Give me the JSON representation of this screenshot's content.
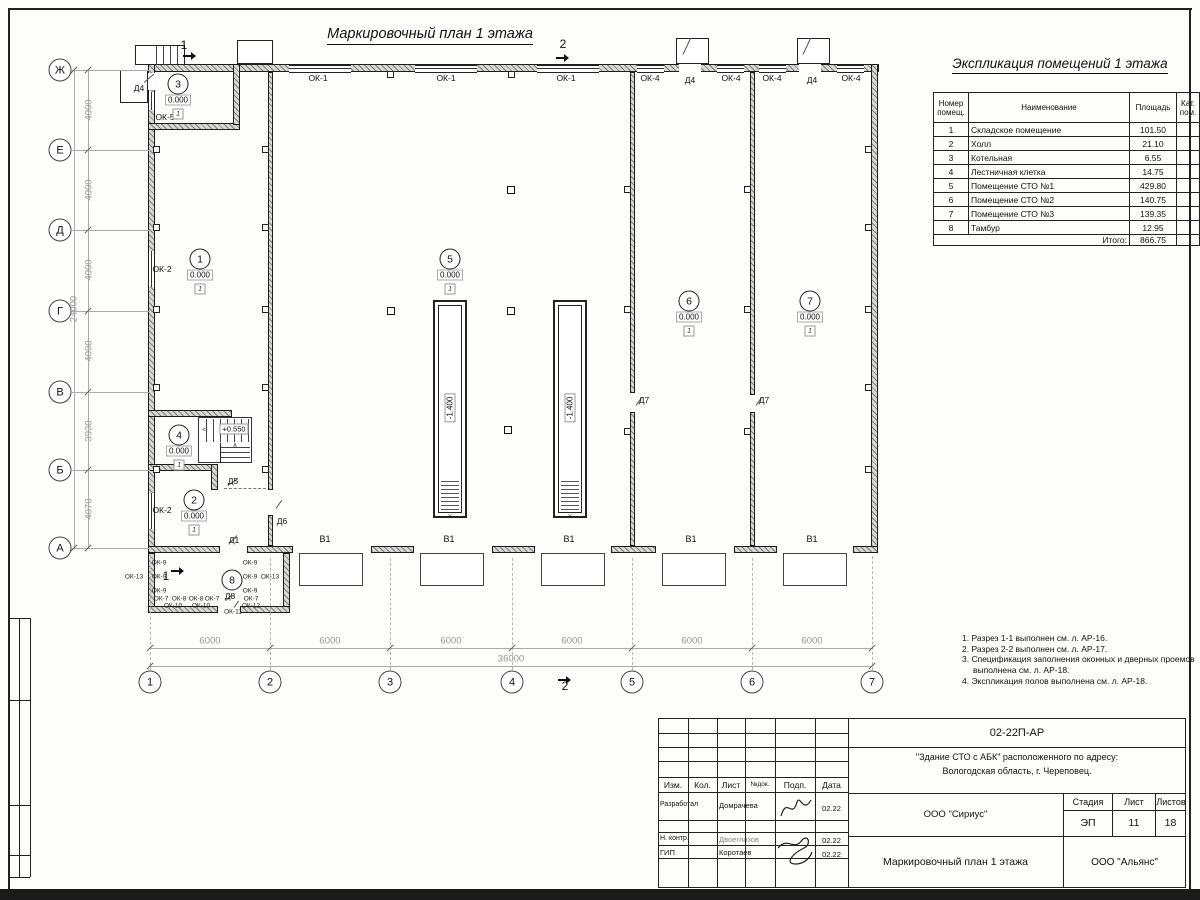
{
  "sheet": {
    "plan_title": "Маркировочный план 1 этажа",
    "expl_title": "Экспликация помещений 1 этажа"
  },
  "expl_table": {
    "headers": [
      "Номер помещ.",
      "Наименование",
      "Площадь",
      "Кат. пом."
    ],
    "rows": [
      [
        "1",
        "Складское помещение",
        "101.50",
        ""
      ],
      [
        "2",
        "Холл",
        "21.10",
        ""
      ],
      [
        "3",
        "Котельная",
        "6.55",
        ""
      ],
      [
        "4",
        "Лестничная клетка",
        "14.75",
        ""
      ],
      [
        "5",
        "Помещение СТО №1",
        "429.80",
        ""
      ],
      [
        "6",
        "Помещение СТО №2",
        "140.75",
        ""
      ],
      [
        "7",
        "Помещение СТО №3",
        "139.35",
        ""
      ],
      [
        "8",
        "Тамбур",
        "12.95",
        ""
      ]
    ],
    "total_label": "Итого:",
    "total_value": "866.75"
  },
  "notes": [
    "1. Разрез 1-1 выполнен см. л. АР-16.",
    "2. Разрез 2-2 выполнен см. л. АР-17.",
    "3. Спецификация заполнения оконных и дверных проемов выполнена см. л. АР-18.",
    "4. Экспликация полов выполнена см. л. АР-18."
  ],
  "plan": {
    "axis_rows": [
      {
        "t": "Ж",
        "x": 60,
        "y": 70
      },
      {
        "t": "Е",
        "x": 60,
        "y": 150
      },
      {
        "t": "Д",
        "x": 60,
        "y": 230
      },
      {
        "t": "Г",
        "x": 60,
        "y": 311
      },
      {
        "t": "В",
        "x": 60,
        "y": 392
      },
      {
        "t": "Б",
        "x": 60,
        "y": 470
      },
      {
        "t": "А",
        "x": 60,
        "y": 548
      }
    ],
    "axis_cols": [
      {
        "t": "1",
        "x": 150,
        "y": 682
      },
      {
        "t": "2",
        "x": 270,
        "y": 682
      },
      {
        "t": "3",
        "x": 390,
        "y": 682
      },
      {
        "t": "4",
        "x": 512,
        "y": 682
      },
      {
        "t": "5",
        "x": 632,
        "y": 682
      },
      {
        "t": "6",
        "x": 752,
        "y": 682
      },
      {
        "t": "7",
        "x": 872,
        "y": 682
      }
    ],
    "dims": [
      {
        "t": "4000",
        "x": 89,
        "y": 110,
        "r": 1
      },
      {
        "t": "4000",
        "x": 89,
        "y": 190,
        "r": 1
      },
      {
        "t": "4000",
        "x": 89,
        "y": 270,
        "r": 1
      },
      {
        "t": "4000",
        "x": 89,
        "y": 351,
        "r": 1
      },
      {
        "t": "3930",
        "x": 89,
        "y": 431,
        "r": 1
      },
      {
        "t": "4070",
        "x": 89,
        "y": 509,
        "r": 1
      },
      {
        "t": "24000",
        "x": 74,
        "y": 309,
        "r": 1
      },
      {
        "t": "6000",
        "x": 210,
        "y": 641
      },
      {
        "t": "6000",
        "x": 330,
        "y": 641
      },
      {
        "t": "6000",
        "x": 451,
        "y": 641
      },
      {
        "t": "6000",
        "x": 572,
        "y": 641
      },
      {
        "t": "6000",
        "x": 692,
        "y": 641
      },
      {
        "t": "6000",
        "x": 812,
        "y": 641
      },
      {
        "t": "36000",
        "x": 511,
        "y": 659
      }
    ],
    "rooms": [
      {
        "n": "1",
        "x": 200,
        "y": 259,
        "e": "0.000",
        "f": "1"
      },
      {
        "n": "2",
        "x": 194,
        "y": 500,
        "e": "0.000",
        "f": "1"
      },
      {
        "n": "3",
        "x": 178,
        "y": 84,
        "e": "0.000",
        "f": "1"
      },
      {
        "n": "4",
        "x": 179,
        "y": 435,
        "e": "0.000",
        "f": "1"
      },
      {
        "n": "5",
        "x": 450,
        "y": 259,
        "e": "0.000",
        "f": "1"
      },
      {
        "n": "6",
        "x": 689,
        "y": 301,
        "e": "0.000",
        "f": "1"
      },
      {
        "n": "7",
        "x": 810,
        "y": 301,
        "e": "0.000",
        "f": "1"
      },
      {
        "n": "8",
        "x": 232,
        "y": 580
      }
    ],
    "labels": [
      {
        "t": "ОК-1",
        "x": 318,
        "y": 78
      },
      {
        "t": "ОК-1",
        "x": 446,
        "y": 78
      },
      {
        "t": "ОК-1",
        "x": 566,
        "y": 78
      },
      {
        "t": "ОК-4",
        "x": 650,
        "y": 78
      },
      {
        "t": "Д4",
        "x": 690,
        "y": 80
      },
      {
        "t": "ОК-4",
        "x": 731,
        "y": 78
      },
      {
        "t": "ОК-4",
        "x": 772,
        "y": 78
      },
      {
        "t": "Д4",
        "x": 812,
        "y": 80
      },
      {
        "t": "ОК-4",
        "x": 851,
        "y": 78
      },
      {
        "t": "Д4",
        "x": 139,
        "y": 88
      },
      {
        "t": "ОК-5",
        "x": 165,
        "y": 117
      },
      {
        "t": "ОК-2",
        "x": 162,
        "y": 269
      },
      {
        "t": "ОК-2",
        "x": 162,
        "y": 510
      },
      {
        "t": "Д5",
        "x": 233,
        "y": 481
      },
      {
        "t": "Д6",
        "x": 282,
        "y": 521
      },
      {
        "t": "Д1",
        "x": 234,
        "y": 540
      },
      {
        "t": "Д7",
        "x": 644,
        "y": 400
      },
      {
        "t": "Д7",
        "x": 764,
        "y": 400
      },
      {
        "t": "Д8",
        "x": 230,
        "y": 596
      },
      {
        "t": "В1",
        "x": 325,
        "y": 539,
        "c": "b1"
      },
      {
        "t": "В1",
        "x": 449,
        "y": 539,
        "c": "b1"
      },
      {
        "t": "В1",
        "x": 569,
        "y": 539,
        "c": "b1"
      },
      {
        "t": "В1",
        "x": 691,
        "y": 539,
        "c": "b1"
      },
      {
        "t": "В1",
        "x": 812,
        "y": 539,
        "c": "b1"
      },
      {
        "t": "ОК-13",
        "x": 134,
        "y": 577,
        "c": "t6"
      },
      {
        "t": "ОК-13",
        "x": 270,
        "y": 577,
        "c": "t6"
      },
      {
        "t": "ОК-9",
        "x": 159,
        "y": 563,
        "c": "t6"
      },
      {
        "t": "ОК-9",
        "x": 159,
        "y": 577,
        "c": "t6"
      },
      {
        "t": "ОК-9",
        "x": 159,
        "y": 591,
        "c": "t6"
      },
      {
        "t": "ОК-9",
        "x": 250,
        "y": 563,
        "c": "t6"
      },
      {
        "t": "ОК-9",
        "x": 250,
        "y": 577,
        "c": "t6"
      },
      {
        "t": "ОК-9",
        "x": 250,
        "y": 591,
        "c": "t6"
      },
      {
        "t": "ОК-7",
        "x": 161,
        "y": 599,
        "c": "t6"
      },
      {
        "t": "ОК-8",
        "x": 179,
        "y": 599,
        "c": "t6"
      },
      {
        "t": "ОК-8",
        "x": 196,
        "y": 599,
        "c": "t6"
      },
      {
        "t": "ОК-7",
        "x": 212,
        "y": 599,
        "c": "t6"
      },
      {
        "t": "ОК-7",
        "x": 251,
        "y": 599,
        "c": "t6"
      },
      {
        "t": "ОК-10",
        "x": 173,
        "y": 606,
        "c": "t6"
      },
      {
        "t": "ОК-10",
        "x": 201,
        "y": 606,
        "c": "t6"
      },
      {
        "t": "ОК-11",
        "x": 233,
        "y": 612,
        "c": "t6"
      },
      {
        "t": "ОК-12",
        "x": 251,
        "y": 606,
        "c": "t6"
      },
      {
        "t": "1",
        "x": 184,
        "y": 45,
        "c": "sec"
      },
      {
        "t": "2",
        "x": 563,
        "y": 44,
        "c": "sec"
      },
      {
        "t": "2",
        "x": 565,
        "y": 686,
        "c": "sec"
      },
      {
        "t": "1",
        "x": 166,
        "y": 576,
        "c": "sec"
      },
      {
        "t": "+0.550",
        "x": 234,
        "y": 429,
        "c": "elvbox"
      },
      {
        "t": "-1.400",
        "x": 450,
        "y": 408,
        "c": "elvrot"
      },
      {
        "t": "-1.400",
        "x": 570,
        "y": 408,
        "c": "elvrot"
      },
      {
        "t": "∨",
        "x": 450,
        "y": 516,
        "c": "t6"
      },
      {
        "t": "∨",
        "x": 570,
        "y": 516,
        "c": "t6"
      },
      {
        "t": "<",
        "x": 204,
        "y": 430,
        "c": "t6"
      },
      {
        "t": "∧",
        "x": 235,
        "y": 445,
        "c": "t6"
      }
    ]
  },
  "title_block": {
    "code": "02-22П-АР",
    "project_line1": "\"Здание СТО с АБК\" расположенного по адресу:",
    "project_line2": "Вологодская область, г. Череповец.",
    "org": "ООО \"Сириус\"",
    "org2": "ООО \"Альянс\"",
    "doc_title": "Маркировочный план 1 этажа",
    "stage_label": "Стадия",
    "sheet_label": "Лист",
    "sheets_label": "Листов",
    "stage": "ЭП",
    "sheet": "11",
    "sheets": "18",
    "cols": [
      "Изм.",
      "Кол.",
      "Лист",
      "№док.",
      "Подп.",
      "Дата"
    ],
    "rows": [
      {
        "role": "Разработал",
        "name": "Домрачева",
        "date": "02.22"
      },
      {
        "role": "Н. контр.",
        "name": "Двоеглазов",
        "date": "02.22"
      },
      {
        "role": "ГИП",
        "name": "Коротаев",
        "date": "02.22"
      }
    ]
  }
}
